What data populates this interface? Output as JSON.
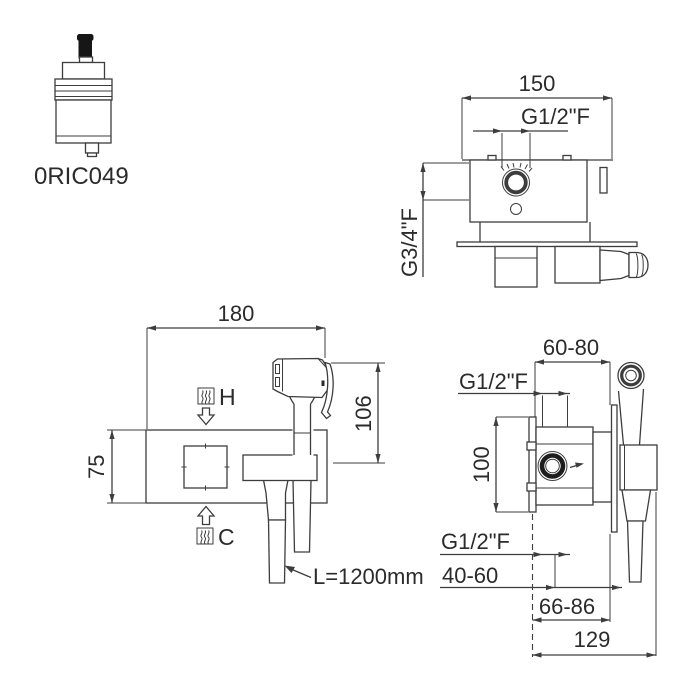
{
  "meta": {
    "background_color": "#ffffff",
    "line_color": "#3d3d3d",
    "text_color": "#2b2b2b",
    "drawing_type": "built-in bidet mixer technical dimension drawing"
  },
  "cartridge": {
    "code": "0RIC049"
  },
  "top_view": {
    "width_dim": "150",
    "outlet_thread": "G1/2\"F",
    "inlet_thread": "G3/4\"F"
  },
  "front_view": {
    "width_dim": "180",
    "height_dim": "106",
    "plate_height_dim": "75",
    "hot_label": "H",
    "cold_label": "C",
    "hose_length": "L=1200mm"
  },
  "side_view": {
    "depth_range_dim": "60-80",
    "top_thread": "G1/2\"F",
    "body_height_dim": "100",
    "bottom_thread": "G1/2\"F",
    "outlet_depth_range": "40-60",
    "plate_depth_range": "66-86",
    "total_depth_dim": "129"
  }
}
